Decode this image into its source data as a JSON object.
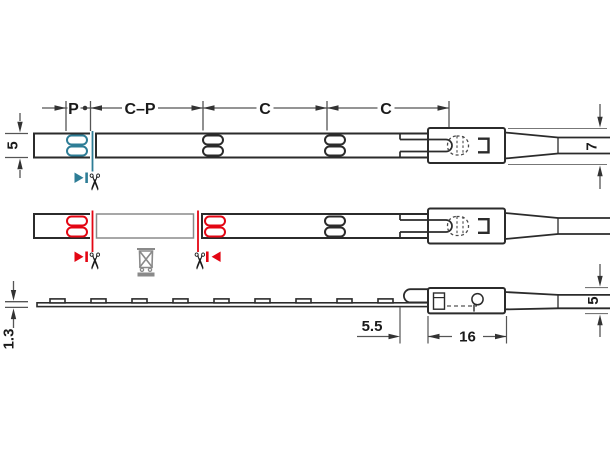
{
  "drawing": {
    "type": "technical-dimension-drawing",
    "views": [
      "top-view-start",
      "top-view-cut-section",
      "side-profile-view"
    ]
  },
  "labels": {
    "pitch": "P",
    "cut_minus_pitch": "C–P",
    "cut_length_1": "C",
    "cut_length_2": "C",
    "strip_width": "5",
    "lead_width_top": "7",
    "strip_thickness": "1.3",
    "led_end_gap": "5.5",
    "connector_length": "16",
    "lead_width_side": "5"
  },
  "icons": {
    "scissors_glyph": "✂"
  },
  "colors": {
    "object_line": "#2b2b2b",
    "dimension_line": "#555555",
    "cut_blue": "#2e7d96",
    "cut_red": "#e30613",
    "muted_gray": "#8a8a8a"
  }
}
